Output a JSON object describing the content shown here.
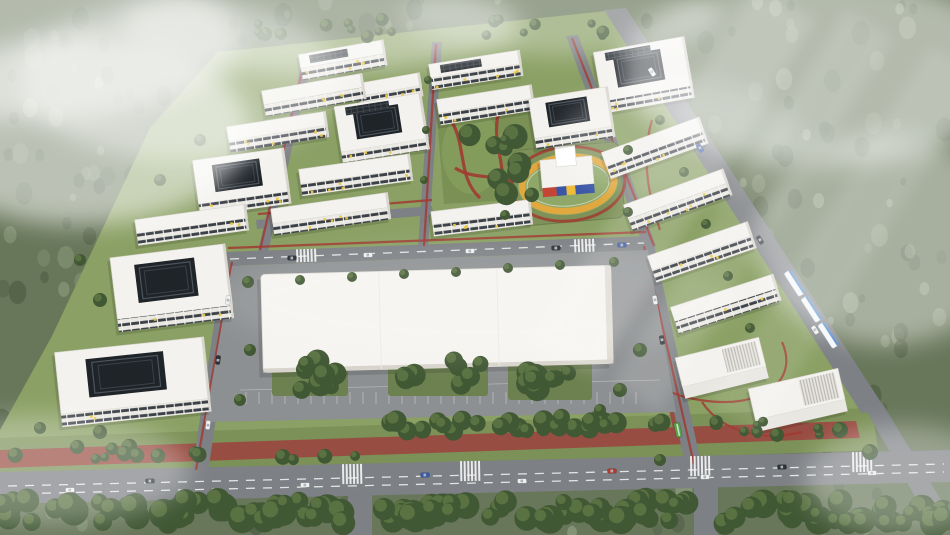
{
  "scene": {
    "palette": {
      "forest_base": "#68775a",
      "forest_dark": "#4e5e44",
      "forest_light": "#8a987b",
      "site_grass": "#8aa064",
      "grass_dark": "#7c9157",
      "road": "#7d8084",
      "marking": "#f5f5f5",
      "red_track": "#9a4a41",
      "path_red": "#a03b31",
      "roof_white": "#f3f2ee",
      "face_shadow": "#d9d6cf",
      "window_dark": "#3b4047",
      "accent_yellow": "#e9c73f",
      "solar_dark": "#272c31",
      "court_dark": "#1f2429",
      "plaza_white": "#f6f4f0",
      "apron_gray": "#8d9092",
      "kg_red": "#c44536",
      "kg_blue": "#3b55a5",
      "kg_yellow": "#eebc3a",
      "track_orange": "#e0a83e",
      "tram_blue": "#4f86c6",
      "tree_dark": "#415835",
      "tree_mid": "#5d7644",
      "fog_white": "#ffffff",
      "car_white": "#f0f0ef",
      "car_dark": "#2c3136",
      "car_blue": "#3a5aa8",
      "car_red": "#b33a2e",
      "bus_green": "#58a04a"
    },
    "site_plate": [
      [
        218,
        52
      ],
      [
        616,
        10
      ],
      [
        870,
        402
      ],
      [
        876,
        446
      ],
      [
        0,
        446
      ],
      [
        0,
        430
      ],
      [
        52,
        336
      ],
      [
        150,
        128
      ]
    ],
    "grass_band": [
      [
        0,
        438
      ],
      [
        872,
        408
      ],
      [
        878,
        450
      ],
      [
        0,
        482
      ]
    ],
    "red_bands": [
      [
        [
          0,
          450
        ],
        [
          856,
          421
        ],
        [
          860,
          438
        ],
        [
          0,
          468
        ]
      ],
      [
        [
          652,
          332
        ],
        [
          666,
          330
        ],
        [
          692,
          440
        ],
        [
          676,
          442
        ]
      ]
    ],
    "roads": [
      [
        [
          0,
          472
        ],
        [
          950,
          450
        ],
        [
          950,
          482
        ],
        [
          0,
          504
        ]
      ],
      [
        [
          226,
          252
        ],
        [
          648,
          236
        ],
        [
          648,
          250
        ],
        [
          226,
          266
        ]
      ],
      [
        [
          224,
          258
        ],
        [
          240,
          258
        ],
        [
          208,
          472
        ],
        [
          192,
          472
        ]
      ],
      [
        [
          638,
          244
        ],
        [
          654,
          244
        ],
        [
          702,
          468
        ],
        [
          686,
          468
        ]
      ],
      [
        [
          348,
          496
        ],
        [
          372,
          495
        ],
        [
          372,
          535
        ],
        [
          348,
          535
        ]
      ],
      [
        [
          694,
          486
        ],
        [
          718,
          485
        ],
        [
          718,
          535
        ],
        [
          694,
          535
        ]
      ],
      [
        [
          604,
          10
        ],
        [
          626,
          8
        ],
        [
          882,
          404
        ],
        [
          862,
          414
        ]
      ],
      [
        [
          862,
          403
        ],
        [
          882,
          403
        ],
        [
          952,
          518
        ],
        [
          934,
          530
        ]
      ],
      [
        [
          304,
          52
        ],
        [
          314,
          53
        ],
        [
          268,
          252
        ],
        [
          258,
          251
        ]
      ],
      [
        [
          432,
          42
        ],
        [
          442,
          42
        ],
        [
          428,
          248
        ],
        [
          418,
          248
        ]
      ],
      [
        [
          566,
          36
        ],
        [
          578,
          35
        ],
        [
          656,
          246
        ],
        [
          644,
          248
        ]
      ],
      [
        [
          256,
          220
        ],
        [
          432,
          206
        ],
        [
          433,
          215
        ],
        [
          257,
          229
        ]
      ]
    ],
    "markings": [
      "M8,486 L944,464",
      "M8,494 L944,472",
      "M230,259 L644,243"
    ],
    "red_lines": [
      "M228,248 L646,232",
      "M196,470 L232,262",
      "M644,246 L694,464",
      "M258,214 L432,200",
      "M306,54 L260,250",
      "M436,44 L424,246",
      "M572,38 L654,246",
      "M438,108 L446,202",
      "M534,102 L544,200",
      "M640,260 C600,330 630,390 700,400",
      "M700,400 C760,410 800,382 782,342",
      "M702,402 C722,432 762,442 802,432",
      "M652,120 C640,160 650,200 660,230"
    ],
    "crosswalks": [
      [
        352,
        464,
        -1,
        20
      ],
      [
        470,
        461,
        -1,
        20
      ],
      [
        700,
        456,
        -1,
        20
      ],
      [
        862,
        452,
        -1,
        20
      ],
      [
        306,
        249,
        -2,
        13
      ],
      [
        584,
        239,
        -2,
        13
      ]
    ],
    "buildings": [
      [
        343,
        60,
        86,
        14,
        12,
        -10,
        0,
        1
      ],
      [
        314,
        95,
        102,
        14,
        12,
        -10,
        0,
        0
      ],
      [
        390,
        90,
        64,
        13,
        11,
        -10,
        0,
        0
      ],
      [
        382,
        128,
        88,
        46,
        11,
        -9,
        1,
        1
      ],
      [
        278,
        132,
        100,
        14,
        12,
        -9,
        0,
        0
      ],
      [
        242,
        182,
        92,
        44,
        12,
        -8,
        1,
        0
      ],
      [
        356,
        175,
        112,
        15,
        12,
        -8,
        0,
        0
      ],
      [
        331,
        214,
        118,
        15,
        12,
        -8,
        0,
        0
      ],
      [
        192,
        225,
        112,
        14,
        12,
        -8,
        0,
        0
      ],
      [
        172,
        288,
        116,
        62,
        13,
        -7,
        1,
        0
      ],
      [
        133,
        382,
        150,
        62,
        13,
        -6,
        1,
        0
      ],
      [
        476,
        70,
        92,
        14,
        12,
        -9,
        0,
        1
      ],
      [
        486,
        105,
        96,
        14,
        12,
        -9,
        0,
        0
      ],
      [
        572,
        118,
        80,
        40,
        11,
        -9,
        1,
        0
      ],
      [
        482,
        218,
        100,
        13,
        12,
        -7,
        0,
        0
      ],
      [
        644,
        75,
        92,
        50,
        12,
        -10,
        1,
        1
      ],
      [
        655,
        148,
        104,
        15,
        13,
        -20,
        0,
        0
      ],
      [
        678,
        200,
        106,
        15,
        13,
        -20,
        0,
        0
      ],
      [
        702,
        252,
        106,
        15,
        13,
        -19,
        0,
        0
      ],
      [
        726,
        304,
        108,
        15,
        13,
        -18,
        0,
        0
      ],
      [
        722,
        368,
        86,
        30,
        12,
        -14,
        2,
        0
      ],
      [
        798,
        400,
        92,
        32,
        12,
        -13,
        2,
        0
      ]
    ],
    "park": {
      "poly": [
        [
          436,
          106
        ],
        [
          532,
          100
        ],
        [
          544,
          198
        ],
        [
          444,
          204
        ]
      ],
      "paths": [
        "M448,116 C468,142 456,176 480,198",
        "M500,108 C488,142 512,172 498,196",
        "M455,168 C477,182 502,172 522,186"
      ]
    },
    "kindergarten": {
      "rot": -5,
      "pivot": [
        568,
        184
      ],
      "lot": [
        514,
        146,
        108,
        76
      ],
      "inner_green": [
        568,
        184,
        46,
        27
      ],
      "ring": [
        568,
        184,
        46,
        27
      ],
      "red_path": [
        568,
        184,
        57,
        37
      ],
      "main": [
        542,
        158,
        52,
        28
      ],
      "tower": [
        558,
        146,
        20,
        20
      ],
      "band": [
        542,
        186,
        52,
        9
      ],
      "band_segs": [
        [
          14,
          "kg_red"
        ],
        [
          10,
          "kg_blue"
        ],
        [
          9,
          "kg_yellow"
        ],
        [
          19,
          "kg_blue"
        ]
      ]
    },
    "plaza": {
      "rot": -1.5,
      "pivot": [
        435,
        318
      ],
      "rect": [
        262,
        270,
        350,
        98
      ],
      "apron": [
        [
          232,
          266
        ],
        [
          648,
          250
        ],
        [
          676,
          412
        ],
        [
          205,
          422
        ]
      ],
      "clusters": [
        [
          272,
          352,
          76,
          44
        ],
        [
          388,
          350,
          100,
          46
        ],
        [
          508,
          354,
          84,
          46
        ]
      ],
      "stalls": {
        "x0": 246,
        "x1": 646,
        "step": 13,
        "y0": 392,
        "y1": 404
      }
    },
    "tree_bands": [
      {
        "x0": 385,
        "x1": 665,
        "y": 424,
        "jit": 8,
        "count": 30,
        "r0": 7,
        "r1": 11,
        "gaps": []
      },
      {
        "x0": 5,
        "x1": 360,
        "y": 452,
        "jit": 8,
        "count": 15,
        "r0": 4,
        "r1": 8,
        "gaps": []
      },
      {
        "x0": 700,
        "x1": 854,
        "y": 428,
        "jit": 7,
        "count": 10,
        "r0": 4,
        "r1": 7,
        "gaps": []
      },
      {
        "x0": -5,
        "x1": 955,
        "y": 512,
        "jit": 12,
        "count": 130,
        "r0": 8,
        "r1": 15,
        "gaps": [
          [
            346,
            376
          ],
          [
            692,
            722
          ]
        ]
      },
      {
        "x0": 240,
        "x1": 640,
        "y": 28,
        "jit": 9,
        "count": 20,
        "r0": 4,
        "r1": 7,
        "gaps": []
      }
    ],
    "single_trees": [
      [
        248,
        282,
        6
      ],
      [
        300,
        280,
        5
      ],
      [
        352,
        277,
        5
      ],
      [
        404,
        274,
        5
      ],
      [
        456,
        272,
        5
      ],
      [
        508,
        268,
        5
      ],
      [
        560,
        265,
        5
      ],
      [
        614,
        262,
        5
      ],
      [
        200,
        140,
        6
      ],
      [
        160,
        180,
        6
      ],
      [
        100,
        300,
        7
      ],
      [
        80,
        260,
        6
      ],
      [
        250,
        350,
        6
      ],
      [
        240,
        400,
        6
      ],
      [
        660,
        120,
        5
      ],
      [
        684,
        172,
        5
      ],
      [
        706,
        224,
        5
      ],
      [
        728,
        276,
        5
      ],
      [
        750,
        328,
        5
      ],
      [
        640,
        350,
        7
      ],
      [
        620,
        390,
        7
      ],
      [
        600,
        410,
        6
      ],
      [
        840,
        430,
        8
      ],
      [
        870,
        452,
        8
      ],
      [
        660,
        460,
        6
      ],
      [
        100,
        432,
        7
      ],
      [
        40,
        428,
        6
      ],
      [
        428,
        80,
        4
      ],
      [
        426,
        130,
        4
      ],
      [
        424,
        180,
        4
      ],
      [
        505,
        140,
        5
      ],
      [
        628,
        150,
        5
      ],
      [
        505,
        215,
        5
      ],
      [
        628,
        212,
        5
      ]
    ],
    "cars": [
      [
        70,
        490,
        -1,
        "w"
      ],
      [
        150,
        481,
        -1,
        "d"
      ],
      [
        305,
        485,
        -1,
        "w"
      ],
      [
        425,
        475,
        -1,
        "b"
      ],
      [
        522,
        481,
        -1,
        "w"
      ],
      [
        612,
        471,
        -1,
        "r"
      ],
      [
        705,
        477,
        -1,
        "w"
      ],
      [
        782,
        467,
        -1,
        "d"
      ],
      [
        872,
        473,
        -1,
        "w"
      ],
      [
        292,
        258,
        -2,
        "d"
      ],
      [
        368,
        255,
        -2,
        "w"
      ],
      [
        470,
        251,
        -2,
        "w"
      ],
      [
        556,
        248,
        -2,
        "d"
      ],
      [
        622,
        245,
        -2,
        "b"
      ],
      [
        228,
        300,
        -83,
        "w"
      ],
      [
        218,
        360,
        -83,
        "d"
      ],
      [
        208,
        425,
        -83,
        "w"
      ],
      [
        655,
        300,
        80,
        "w"
      ],
      [
        662,
        340,
        80,
        "d"
      ],
      [
        652,
        72,
        57,
        "w"
      ],
      [
        760,
        240,
        57,
        "d"
      ],
      [
        815,
        330,
        57,
        "w"
      ],
      [
        700,
        148,
        57,
        "b"
      ]
    ],
    "bus": [
      678,
      430,
      78
    ],
    "tram": {
      "cx": 812,
      "cy": 310,
      "rot": 57
    },
    "fog": {
      "patches": [
        [
          80,
          130,
          170,
          95,
          0.55
        ],
        [
          30,
          40,
          210,
          80,
          0.5
        ],
        [
          180,
          80,
          160,
          80,
          0.4
        ],
        [
          320,
          25,
          200,
          48,
          0.45
        ],
        [
          560,
          16,
          160,
          40,
          0.32
        ],
        [
          820,
          70,
          200,
          95,
          0.5
        ],
        [
          885,
          240,
          130,
          105,
          0.42
        ],
        [
          40,
          470,
          150,
          55,
          0.3
        ],
        [
          905,
          480,
          100,
          55,
          0.32
        ],
        [
          680,
          140,
          120,
          60,
          0.22
        ],
        [
          480,
          300,
          260,
          60,
          0.1
        ]
      ],
      "streaks": [
        [
          640,
          -30,
          70,
          420,
          0.16
        ],
        [
          725,
          -10,
          55,
          440,
          0.13
        ],
        [
          815,
          30,
          60,
          420,
          0.11
        ]
      ]
    }
  }
}
